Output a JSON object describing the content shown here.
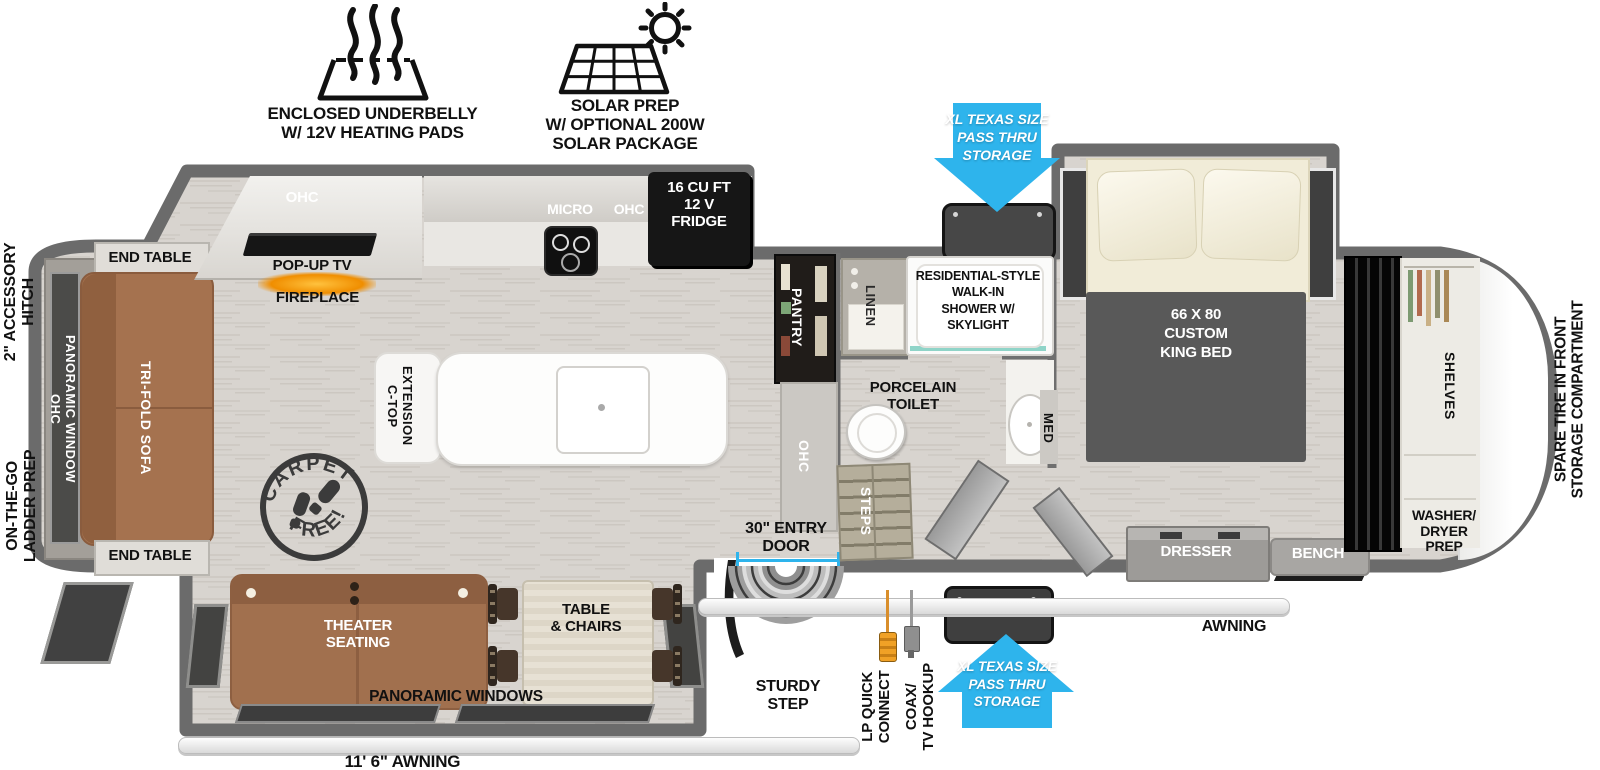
{
  "colors": {
    "arrow_blue": "#2eb4ec",
    "wall_gray": "#6b6b6b",
    "floor": "#d8d4cf",
    "sofa_brown": "#a5724f",
    "appliance_black": "#161616",
    "bed_gray": "#595959",
    "cream": "#f1ecd8",
    "shower_glass_teal": "#8fd4c8",
    "fireplace_orange": "#f08e00"
  },
  "icons": {
    "underbelly": {
      "label": "ENCLOSED UNDERBELLY\nW/ 12V HEATING PADS"
    },
    "solar": {
      "label": "SOLAR PREP\nW/ OPTIONAL 200W\nSOLAR PACKAGE"
    }
  },
  "callouts": {
    "pass_thru_top": "XL TEXAS SIZE\nPASS THRU\nSTORAGE",
    "pass_thru_bottom": "XL TEXAS SIZE\nPASS THRU\nSTORAGE",
    "accessory_hitch": "2\" ACCESSORY\nHITCH",
    "ladder_prep": "ON-THE-GO\nLADDER PREP",
    "spare_tire": "SPARE TIRE IN FRONT\nSTORAGE COMPARTMENT",
    "entry_door": "30\" ENTRY\nDOOR",
    "sturdy_step": "STURDY\nSTEP",
    "lp_quick_connect": "LP QUICK\nCONNECT",
    "coax_tv": "COAX/\nTV HOOKUP",
    "awning": "AWNING",
    "awning_length": "11' 6\" AWNING"
  },
  "living": {
    "ohc": "OHC",
    "popup_tv": "POP-UP TV",
    "fireplace": "FIREPLACE",
    "end_table_top": "END TABLE",
    "end_table_bottom": "END TABLE",
    "sofa": "TRI-FOLD SOFA",
    "rear_window": "OHC\nPANORAMIC WINDOW",
    "stamp_top": "CARPET",
    "stamp_bottom": "FREE!",
    "ctop_extension": "C-TOP\nEXTENSION",
    "theater": "THEATER\nSEATING",
    "dinette": "TABLE\n& CHAIRS",
    "panoramic_windows": "PANORAMIC WINDOWS"
  },
  "kitchen": {
    "micro": "MICRO",
    "ohc": "OHC",
    "fridge": "16 CU FT\n12 V\nFRIDGE",
    "pantry": "PANTRY",
    "ohc_hall": "OHC"
  },
  "bath": {
    "linen": "LINEN",
    "shower": "RESIDENTIAL-STYLE\nWALK-IN\nSHOWER W/\nSKYLIGHT",
    "toilet": "PORCELAIN\nTOILET",
    "med": "MED",
    "steps": "STEPS"
  },
  "bedroom": {
    "bed": "66 X 80\nCUSTOM\nKING BED",
    "dresser": "DRESSER",
    "bench": "BENCH"
  },
  "front": {
    "shelves": "SHELVES",
    "washer_dryer": "WASHER/\nDRYER\nPREP"
  }
}
